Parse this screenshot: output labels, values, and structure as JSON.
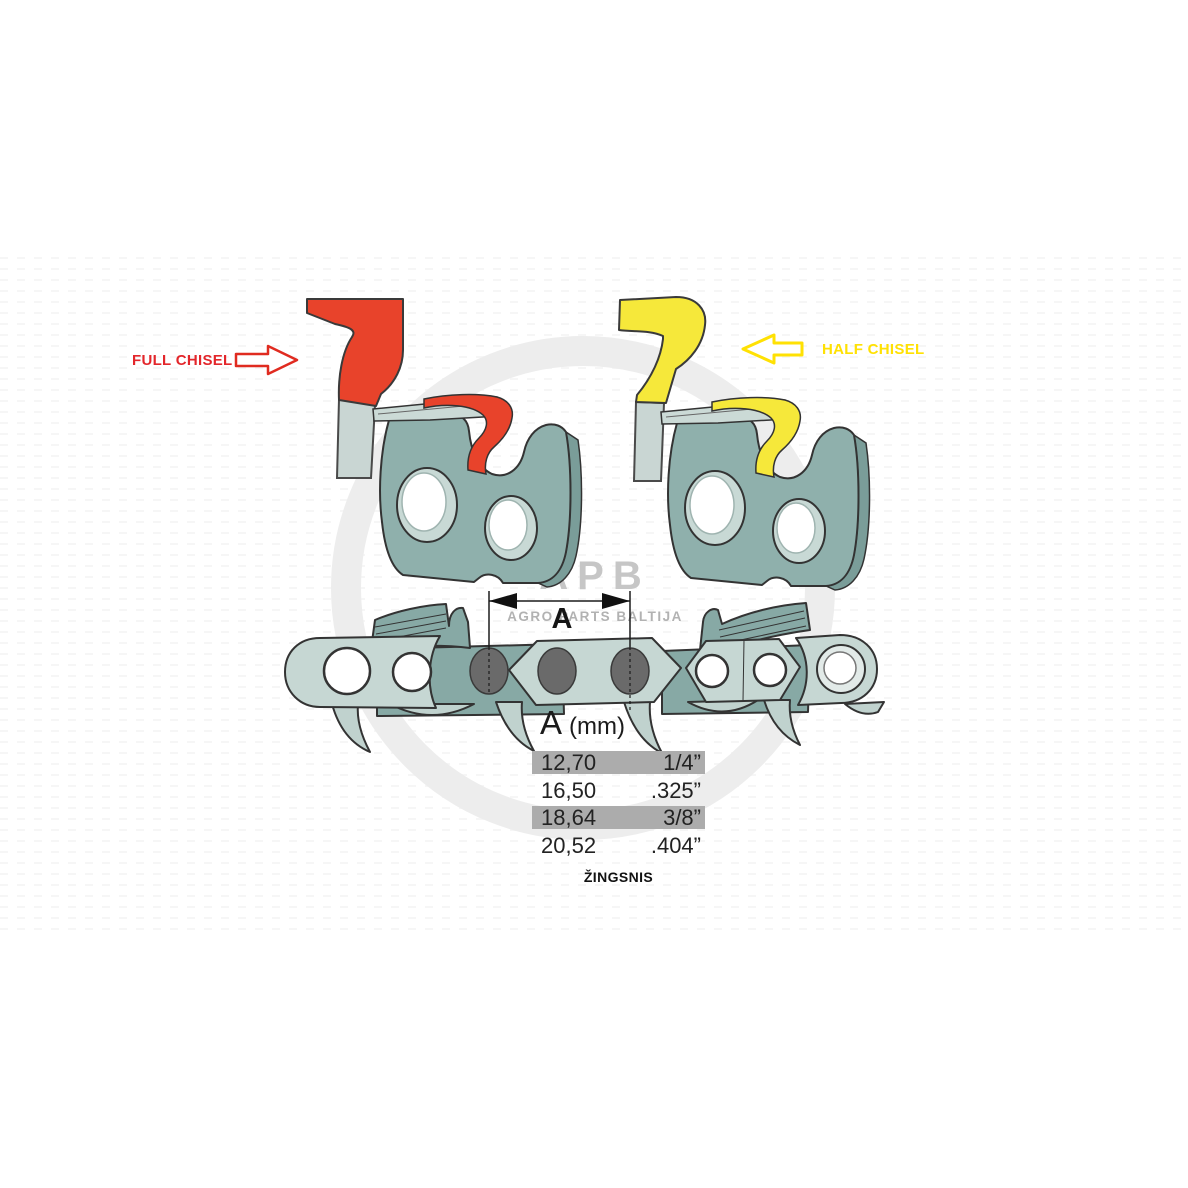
{
  "diagram_title": "chainsaw chain pitch diagram",
  "chisel_labels": {
    "full": {
      "label": "FULL CHISEL",
      "color": "#e3262b"
    },
    "half": {
      "label": "HALF CHISEL",
      "color": "#ffe103"
    }
  },
  "dimension": {
    "label": "A"
  },
  "pitch_table": {
    "header": {
      "letter": "A",
      "unit": "(mm)"
    },
    "rows": [
      {
        "mm": "12,70",
        "inch": "1/4”",
        "highlighted": true
      },
      {
        "mm": "16,50",
        "inch": ".325”",
        "highlighted": false
      },
      {
        "mm": "18,64",
        "inch": "3/8”",
        "highlighted": true
      },
      {
        "mm": "20,52",
        "inch": ".404”",
        "highlighted": false
      }
    ],
    "caption": "ŽINGSNIS"
  },
  "watermark": {
    "logo": "APB",
    "subtitle": "AGRO PARTS BALTIJA"
  },
  "colors": {
    "full_chisel_accent": "#e8432b",
    "half_chisel_accent": "#f6e83a",
    "cutter_body_teal": "#8fb0ac",
    "chain_cutter_teal": "#87a9a5",
    "strap_light_teal": "#c6d7d3",
    "steel_gray": "#c9d6d3",
    "rivet_gray": "#6a6a6a",
    "table_highlight_gray": "#acacac",
    "watermark_gray": "#ededed"
  }
}
